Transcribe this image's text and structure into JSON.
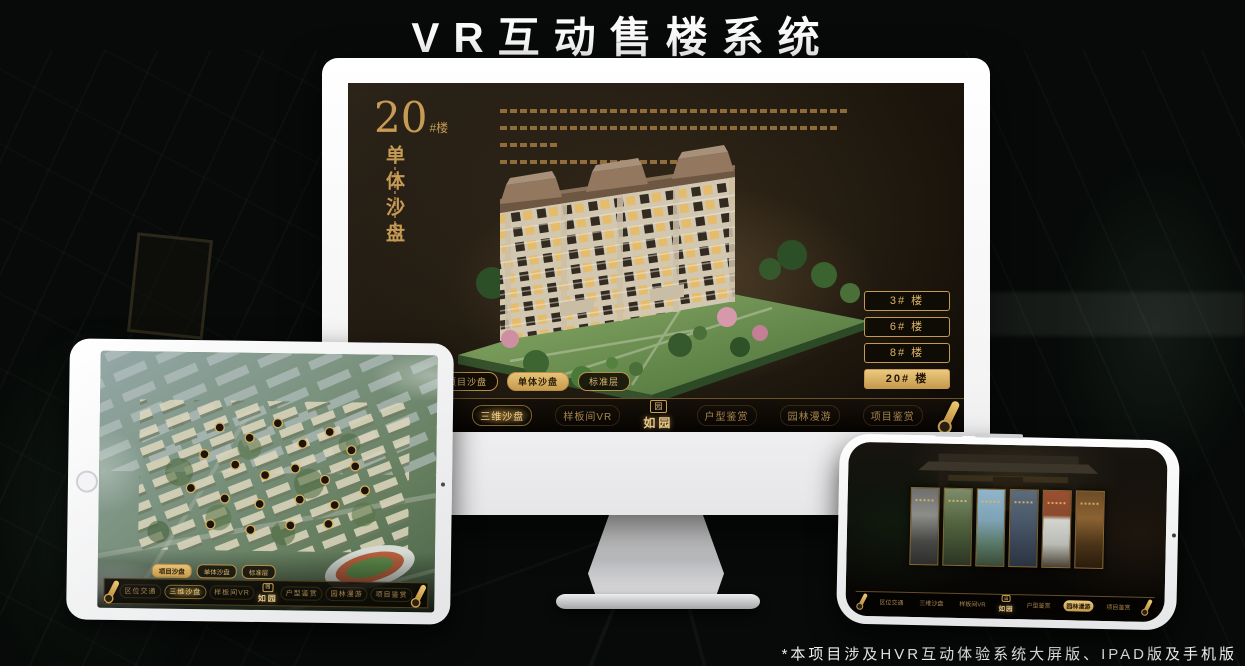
{
  "title": "VR互动售楼系统",
  "footnote": "*本项目涉及HVR互动体验系统大屏版、IPAD版及手机版",
  "logo": {
    "text": "如园",
    "mark": "园"
  },
  "colors": {
    "gold": "#c79b54",
    "gold_bright": "#f2d28c",
    "screen_brown": "#1b150c",
    "accent_active_bg": "#c59a4d"
  },
  "monitor_screen": {
    "headline_number": "20",
    "headline_suffix": "#楼",
    "headline_vertical": "单体沙盘",
    "floor_buttons": [
      {
        "label": "3# 楼",
        "active": false
      },
      {
        "label": "6# 楼",
        "active": false
      },
      {
        "label": "8# 楼",
        "active": false
      },
      {
        "label": "20# 楼",
        "active": true
      }
    ],
    "sub_tabs": [
      {
        "label": "项目沙盘",
        "active": false
      },
      {
        "label": "单体沙盘",
        "active": true
      },
      {
        "label": "标准层",
        "active": false
      }
    ],
    "nav": {
      "left": [
        "区位交通",
        "三维沙盘",
        "样板间VR"
      ],
      "right": [
        "户型鉴赏",
        "园林漫游",
        "项目鉴赏"
      ],
      "active_item": "三维沙盘"
    }
  },
  "tablet_screen": {
    "sub_tabs": [
      {
        "label": "项目沙盘",
        "active": true
      },
      {
        "label": "单体沙盘",
        "active": false
      },
      {
        "label": "标准层",
        "active": false
      }
    ],
    "nav": {
      "left": [
        "区位交通",
        "三维沙盘",
        "样板间VR"
      ],
      "right": [
        "户型鉴赏",
        "园林漫游",
        "项目鉴赏"
      ],
      "active_item": "三维沙盘"
    }
  },
  "phone_screen": {
    "nav": {
      "left": [
        "区位交通",
        "三维沙盘",
        "样板间VR"
      ],
      "right": [
        "户型鉴赏",
        "园林漫游",
        "项目鉴赏"
      ],
      "active_item": "园林漫游"
    }
  }
}
